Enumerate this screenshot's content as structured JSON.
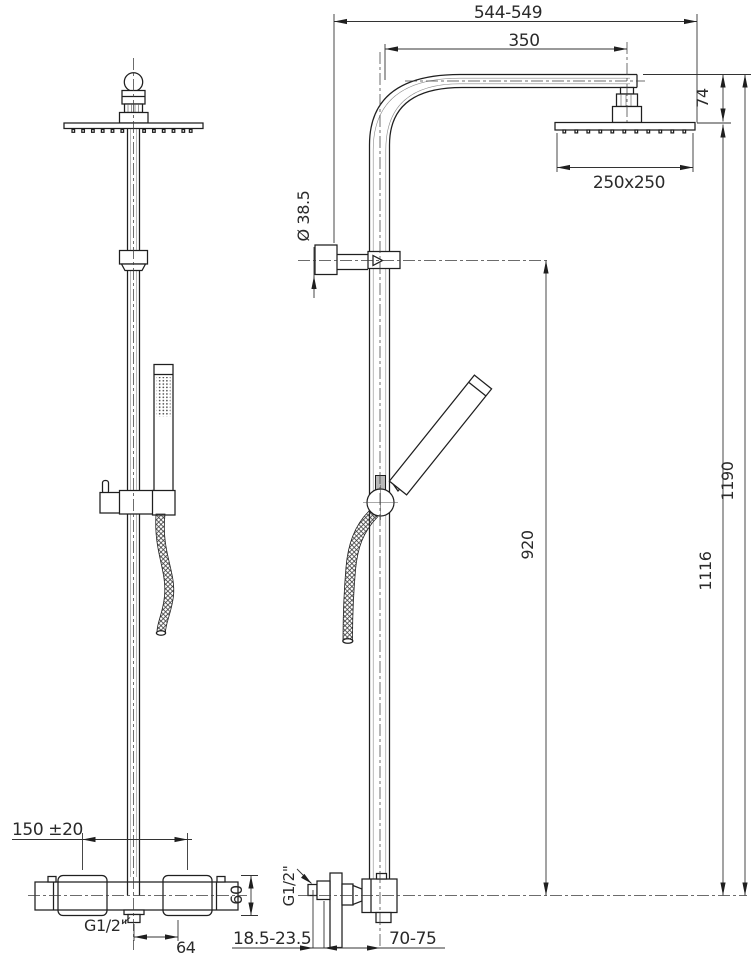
{
  "labels": {
    "top_span": "544-549",
    "arm_length": "350",
    "head_drop": "74",
    "head_size": "250x250",
    "bracket_diameter": "Ø 38.5",
    "bracket_height": "920",
    "head_height": "1116",
    "total_height": "1190",
    "supply_centers": "150 ±20",
    "escutcheon_size": "60",
    "outlet_thread_front": "G1/2\"",
    "outlet_offset": "64",
    "wall_gap": "18.5-23.5",
    "inlet_thread_side": "G1/2\"",
    "wall_to_pipe_center": "70-75"
  }
}
